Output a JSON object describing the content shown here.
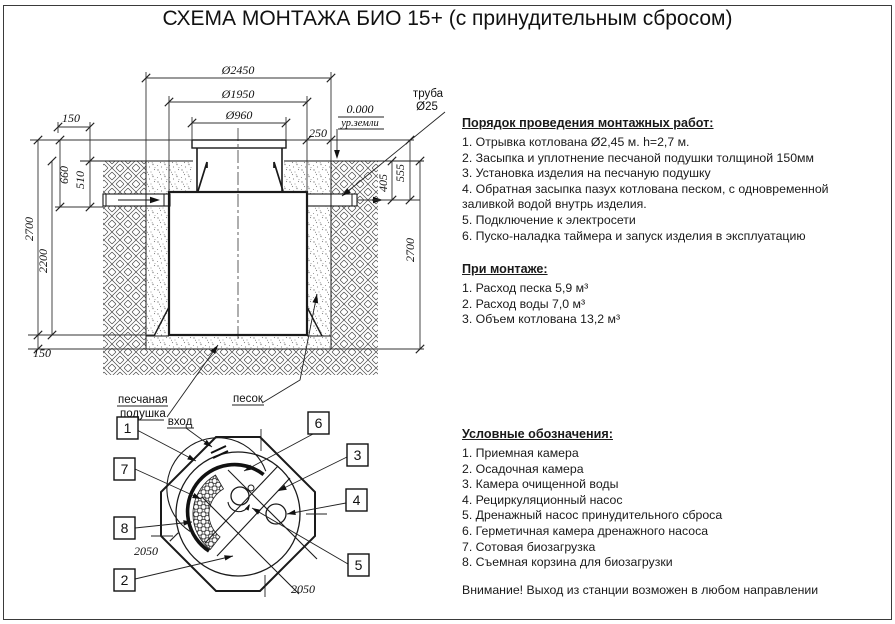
{
  "title": "СХЕМА МОНТАЖА БИО 15+ (с принудительным сбросом)",
  "drawing": {
    "dims": {
      "d2450": "Ø2450",
      "d1950": "Ø1950",
      "d960": "Ø960",
      "level": "0.000",
      "ground_level": "ур.земли",
      "pipe_label_1": "труба",
      "pipe_label_2": "Ø25",
      "gap_250": "250",
      "offset_150": "150",
      "h_660": "660",
      "h_510": "510",
      "depth_2700_left": "2700",
      "h_2200": "2200",
      "cushion_150": "150",
      "depth_2700_right": "2700",
      "h_405": "405",
      "h_555": "555",
      "w_2050_left": "2050",
      "w_2050_bottom": "2050"
    },
    "labels": {
      "sand_cushion_line1": "песчаная",
      "sand_cushion_line2": "подушка",
      "sand": "песок",
      "inlet": "вход"
    },
    "callouts": [
      "1",
      "2",
      "3",
      "4",
      "5",
      "6",
      "7",
      "8"
    ]
  },
  "sections": {
    "procedure": {
      "heading": "Порядок проведения монтажных работ:",
      "items": [
        "1. Отрывка котлована Ø2,45 м. h=2,7 м.",
        "2. Засыпка и уплотнение песчаной подушки толщиной 150мм",
        "3. Установка изделия на песчаную подушку",
        "4. Обратная засыпка пазух котлована песком, с одновременной заливкой водой внутрь изделия.",
        "5. Подключение к электросети",
        "6. Пуско-наладка таймера и запуск изделия в эксплуатацию"
      ]
    },
    "installation": {
      "heading": "При монтаже:",
      "items": [
        "1. Расход песка 5,9 м³",
        "2. Расход воды 7,0 м³",
        "3. Объем котлована 13,2 м³"
      ]
    },
    "legend": {
      "heading": "Условные обозначения:",
      "items": [
        "1. Приемная камера",
        "2. Осадочная камера",
        "3. Камера очищенной воды",
        "4. Рециркуляционный насос",
        "5. Дренажный насос принудительного сброса",
        "6. Герметичная камера дренажного насоса",
        "7. Сотовая биозагрузка",
        "8. Съемная корзина для биозагрузки"
      ]
    },
    "warning": "Внимание! Выход из станции возможен в любом направлении"
  }
}
